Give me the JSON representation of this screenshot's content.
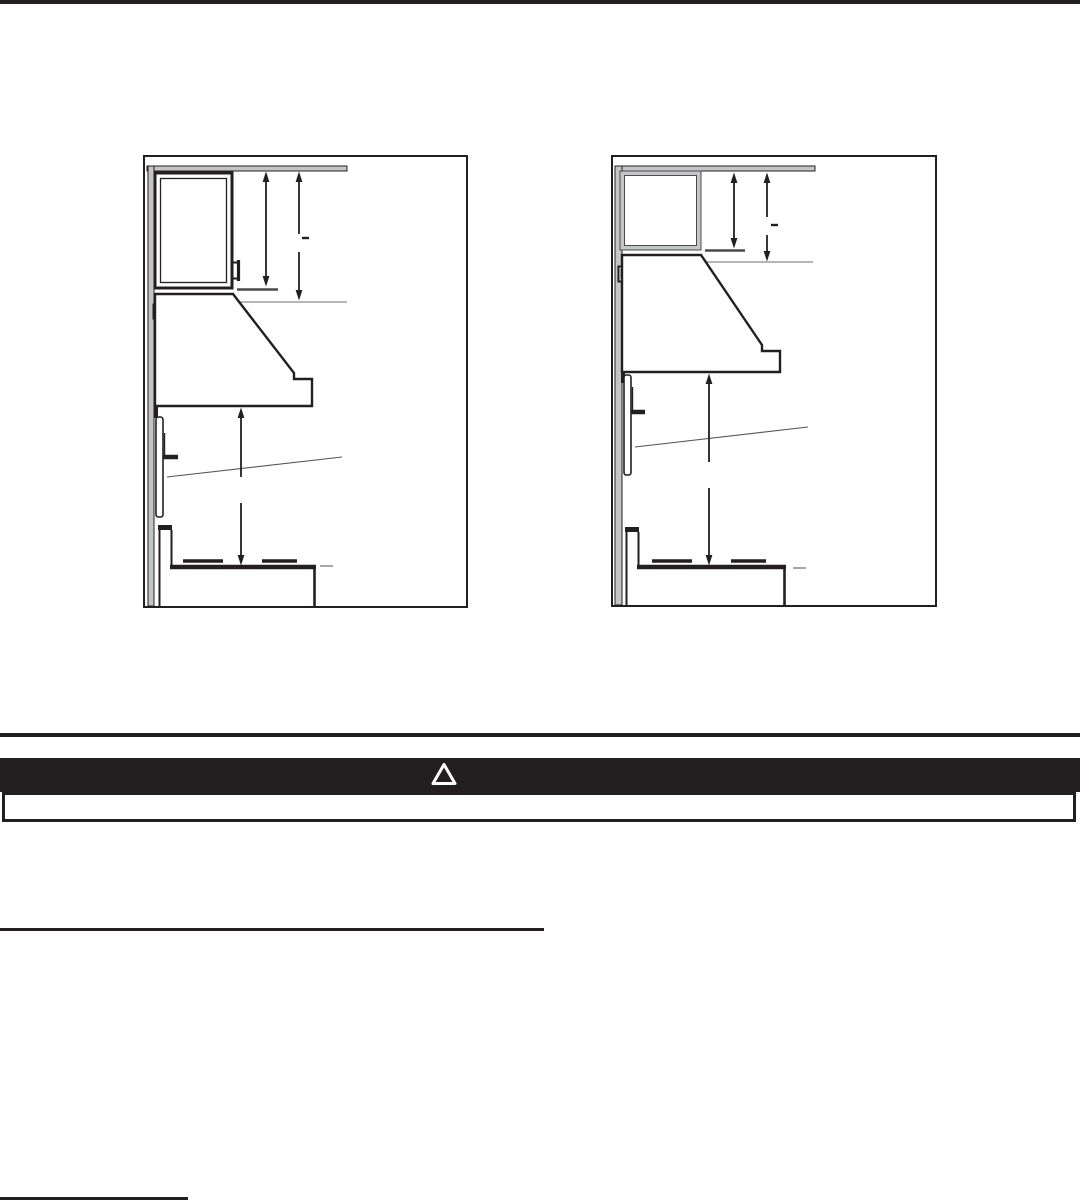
{
  "document": {
    "kind": "range-hood-installation-manual-page",
    "colors": {
      "ink": "#231f20",
      "paper": "#ffffff",
      "section_gray": "#c4c5c7",
      "reference_line_gray": "#8a8a8a",
      "extension_line_gray": "#4a4a4a"
    }
  },
  "figures": {
    "left_diagram": {
      "label": "Side view: hood installed under tall wall cabinet with ceiling-to-cabinet and ceiling-to-hood dimension arrows and hood-to-cooktop dimension arrow"
    },
    "right_diagram": {
      "label": "Side view: hood installed under short wall cabinet with ceiling-to-cabinet and ceiling-to-hood dimension arrows and hood-to-cooktop dimension arrow"
    },
    "dimension_value_placeholder": "–"
  },
  "warning": {
    "banner_color": "#231f20",
    "icon": "warning-triangle-icon",
    "icon_label": "warning triangle"
  }
}
